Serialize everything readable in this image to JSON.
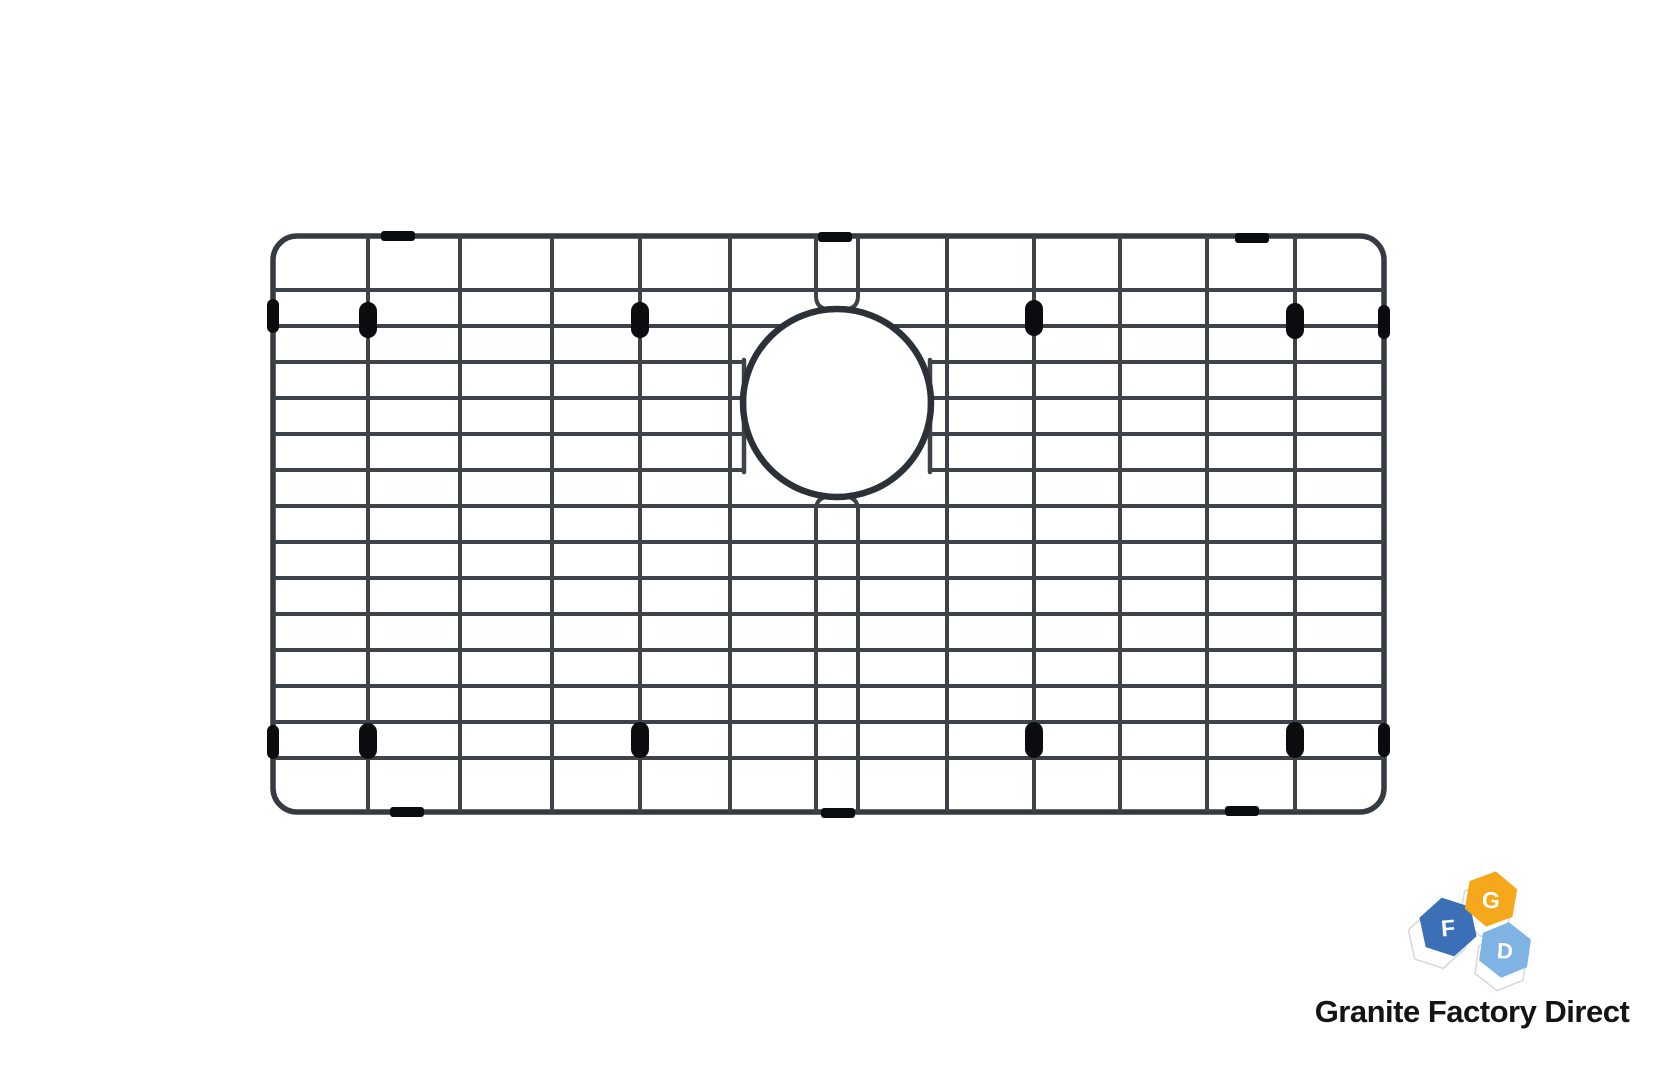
{
  "page": {
    "width": 1671,
    "height": 1066,
    "background": "#ffffff"
  },
  "product_image": {
    "alt": "black stainless steel sink bottom grid with drain cutout and rubber bumpers",
    "colors": {
      "wire": "#3e434a",
      "frame": "#363b41",
      "ring": "#2c3137",
      "bumper": "#0b0c10"
    },
    "frame": {
      "x": 273,
      "y": 236,
      "w": 1111,
      "h": 576,
      "rx": 24,
      "stroke": 5.5
    },
    "wire_stroke": 4,
    "columns_full": [
      368,
      460,
      552,
      640,
      730,
      947,
      1034,
      1120,
      1207,
      1295
    ],
    "rows_full": [
      290,
      506,
      542,
      578,
      614,
      650,
      686,
      722,
      758
    ],
    "row_clipped": {
      "y": 326,
      "left_end": 785,
      "right_start": 889
    },
    "rows_interrupted": [
      362,
      398,
      434,
      470
    ],
    "interrupt_left_end": 744,
    "interrupt_right_start": 930,
    "connector_bars": {
      "xs": [
        744,
        930
      ],
      "y1": 360,
      "y2": 472,
      "stroke": 4.5
    },
    "middle_pair_paths": [
      "M816,236 L816,296 Q816,309 830,309.5",
      "M858,236 L858,296 Q858,309 844,309.5",
      "M816,812 L816,510 Q816,497 830,496.5",
      "M858,812 L858,510 Q858,497 844,496.5"
    ],
    "drain_ring": {
      "cx": 837,
      "cy": 403,
      "r": 94,
      "stroke": 6.5
    },
    "bumpers": {
      "rail_sleeves": [
        {
          "cx": 398,
          "cy": 236
        },
        {
          "cx": 835,
          "cy": 237
        },
        {
          "cx": 1252,
          "cy": 238
        },
        {
          "cx": 407,
          "cy": 812
        },
        {
          "cx": 838,
          "cy": 813
        },
        {
          "cx": 1242,
          "cy": 811
        }
      ],
      "sleeve_size": {
        "w": 34,
        "h": 10,
        "rx": 3
      },
      "frame_pills": [
        {
          "cx": 273,
          "cy": 316
        },
        {
          "cx": 273,
          "cy": 742
        },
        {
          "cx": 1384,
          "cy": 322
        },
        {
          "cx": 1384,
          "cy": 740
        }
      ],
      "frame_pill_size": {
        "w": 12,
        "h": 34,
        "rx": 6
      },
      "wire_pills": [
        {
          "cx": 368,
          "cy": 320
        },
        {
          "cx": 640,
          "cy": 320
        },
        {
          "cx": 1034,
          "cy": 318
        },
        {
          "cx": 1295,
          "cy": 321
        },
        {
          "cx": 368,
          "cy": 741
        },
        {
          "cx": 640,
          "cy": 740
        },
        {
          "cx": 1034,
          "cy": 740
        },
        {
          "cx": 1295,
          "cy": 740
        }
      ],
      "wire_pill_size": {
        "w": 18,
        "h": 36,
        "rx": 9
      }
    }
  },
  "logo": {
    "shadow_fill": "#ffffff",
    "shadow_stroke": "#d8d8d8",
    "letter_color": "#ffffff",
    "shadows": [
      {
        "cx": 1437,
        "cy": 939,
        "r": 30,
        "rotate": -12
      },
      {
        "cx": 1486,
        "cy": 909,
        "r": 28,
        "rotate": 10
      },
      {
        "cx": 1501,
        "cy": 963,
        "r": 28,
        "rotate": 8
      }
    ],
    "hexagons": [
      {
        "id": "hex-d",
        "letter": "D",
        "fill": "#7EB3E3",
        "cx": 1505,
        "cy": 950,
        "r": 28,
        "rotate": 8,
        "letter_size": 22
      },
      {
        "id": "hex-f",
        "letter": "F",
        "fill": "#3B70B7",
        "cx": 1448,
        "cy": 927,
        "r": 30,
        "rotate": -12,
        "letter_size": 23
      },
      {
        "id": "hex-g",
        "letter": "G",
        "fill": "#F6A81C",
        "cx": 1491,
        "cy": 899,
        "r": 28,
        "rotate": 10,
        "letter_size": 23
      }
    ],
    "brand": {
      "text": "Granite Factory Direct",
      "color": "#141414"
    }
  }
}
